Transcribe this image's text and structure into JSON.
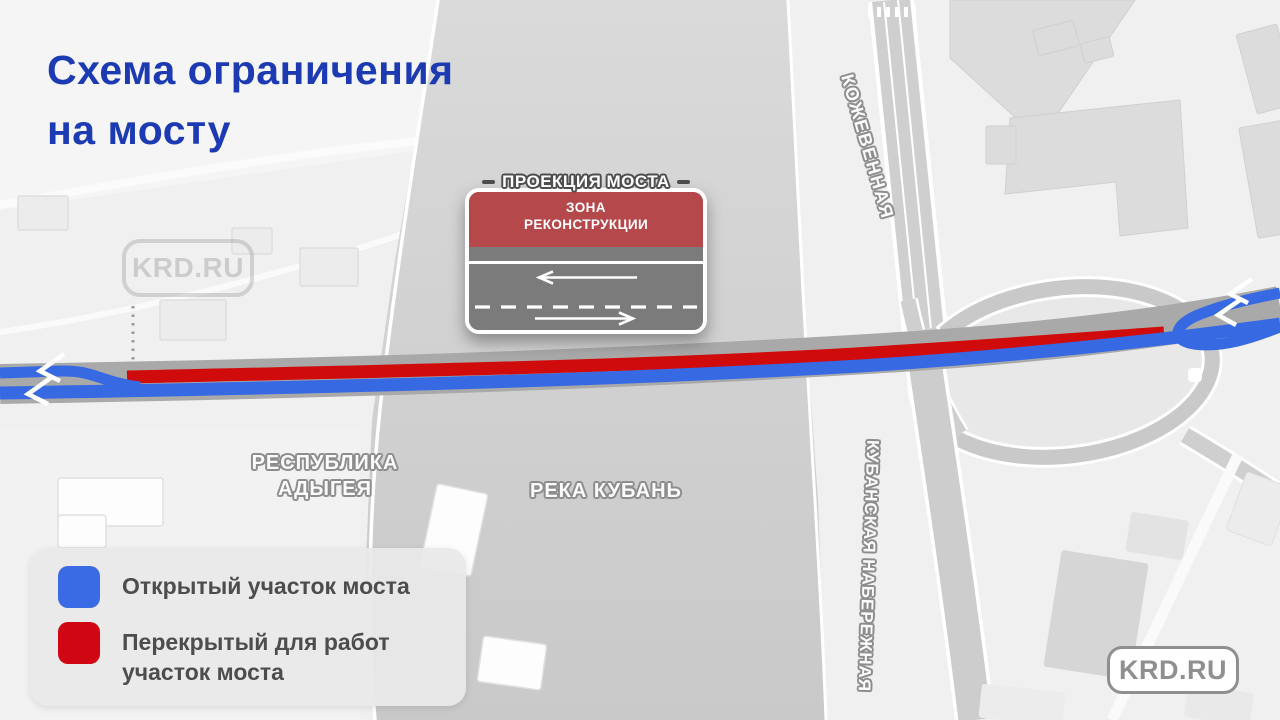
{
  "title": {
    "line1": "Схема ограничения",
    "line2": "на мосту"
  },
  "callout": {
    "title": "ПРОЕКЦИЯ МОСТА",
    "zone_line1": "ЗОНА",
    "zone_line2": "РЕКОНСТРУКЦИИ"
  },
  "map_labels": {
    "street_top": "КОЖЕВЕННАЯ",
    "street_right": "КУБАНСКАЯ НАБЕРЕЖНАЯ",
    "region": "РЕСПУБЛИКА АДЫГЕЯ",
    "river": "РЕКА КУБАНЬ"
  },
  "legend": {
    "items": [
      {
        "swatch_color": "#3B6BE4",
        "label": "Открытый участок моста"
      },
      {
        "swatch_color": "#D00712",
        "label": "Перекрытый для работ участок моста"
      }
    ]
  },
  "watermark_label": "KRD.RU",
  "badge_label": "KRD.RU",
  "colors": {
    "title_blue": "#1C3AB1",
    "open_lane_blue": "#3669E2",
    "closed_lane_red": "#D00B0B",
    "bridge_gray": "#A9A9A9",
    "callout_zone_red": "#B5484B",
    "callout_road_gray": "#7B7B7B",
    "map_road_gray": "#CFCFCF",
    "river_gray": "#D2D2D2"
  }
}
